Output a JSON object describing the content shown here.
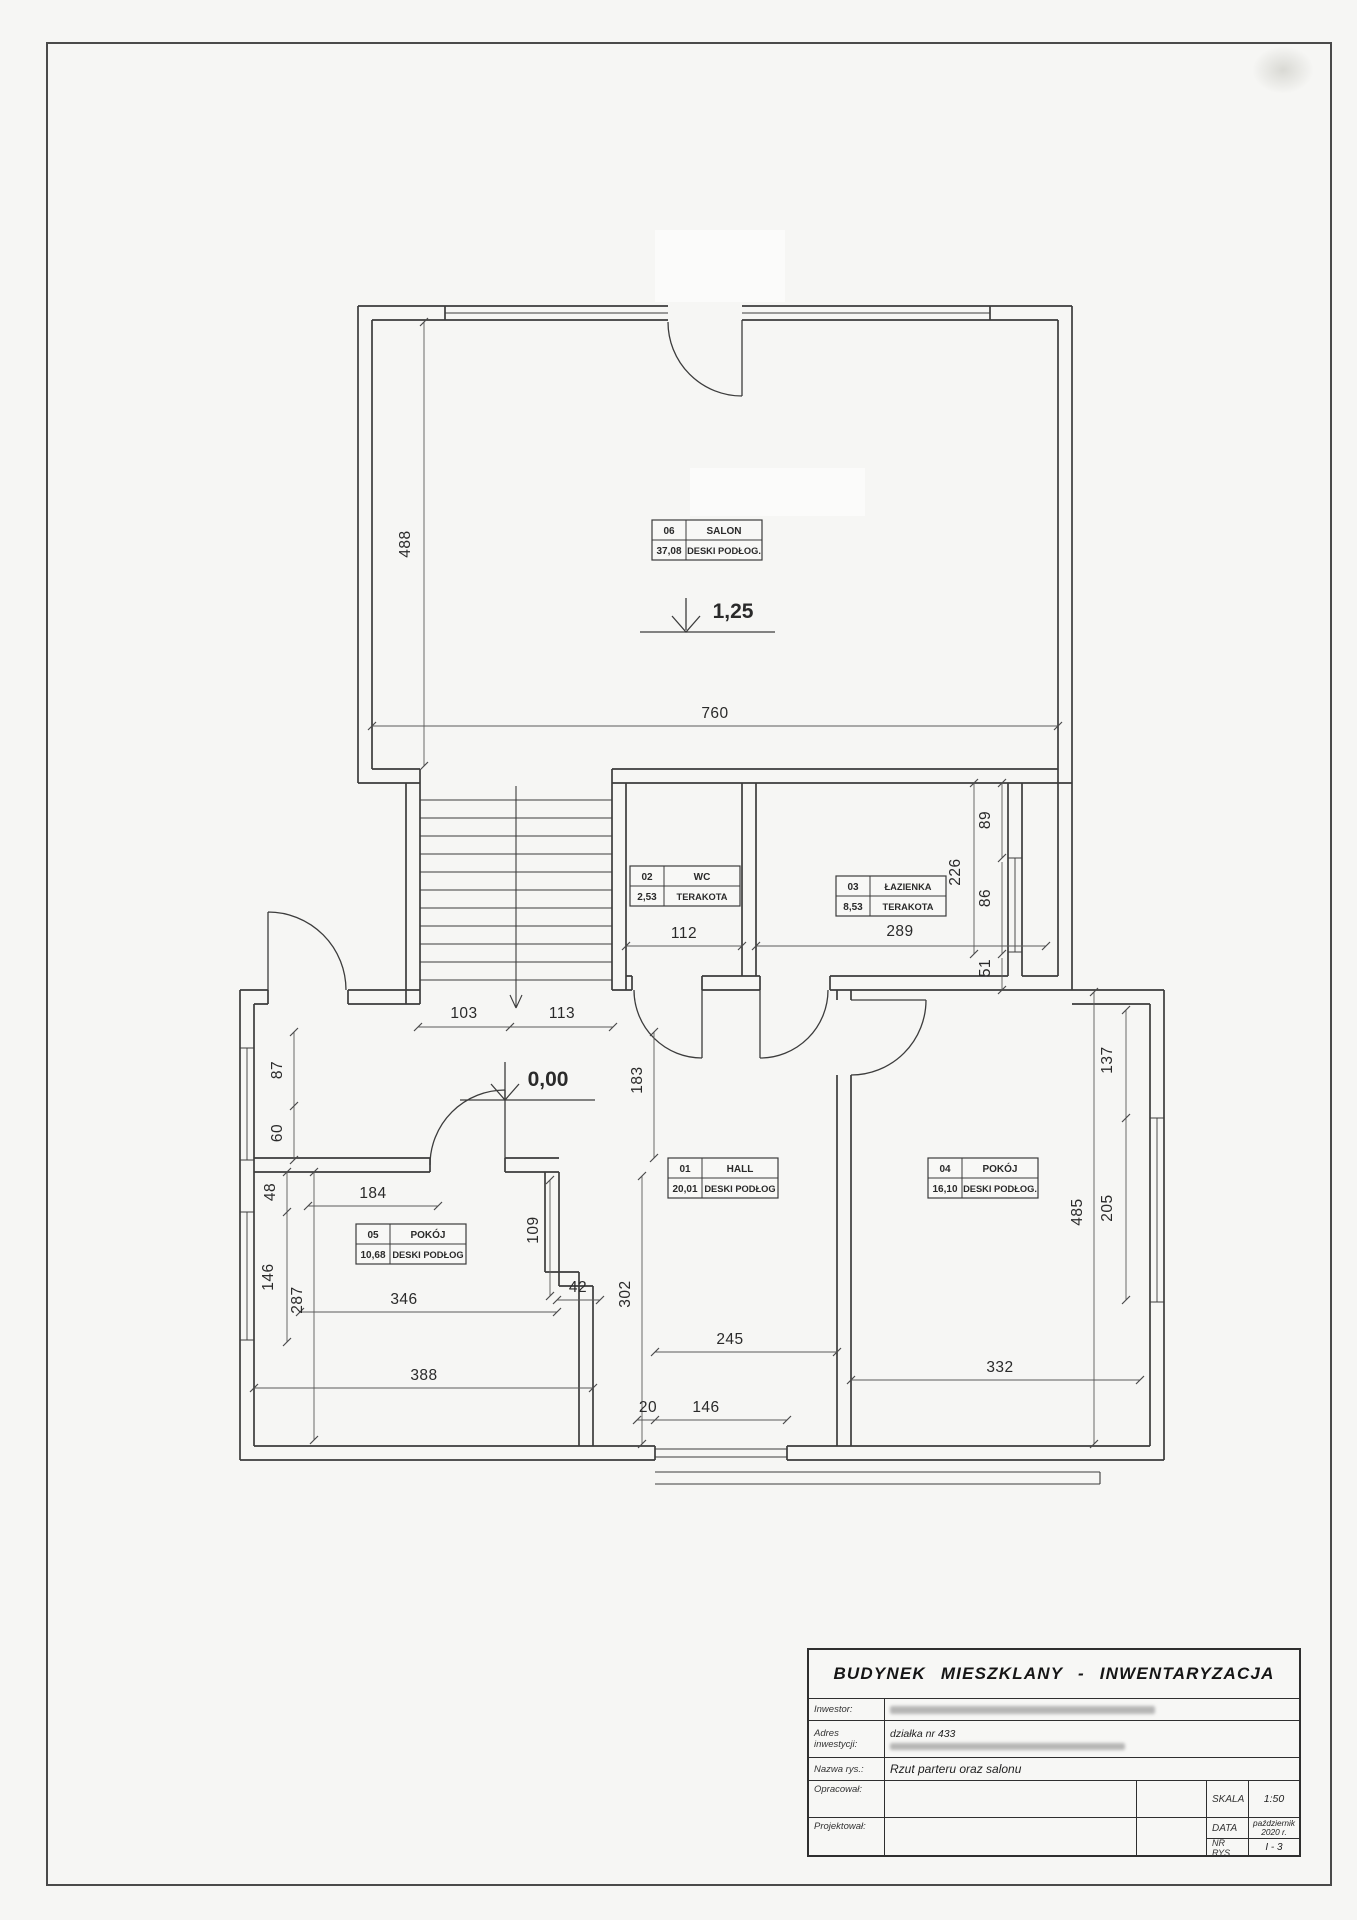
{
  "title_block": {
    "title": "BUDYNEK MIESZKLANY - INWENTARYZACJA",
    "inwestor_label": "Inwestor:",
    "adres_label": "Adres inwestycji:",
    "adres_value": "działka nr 433",
    "nazwa_label": "Nazwa rys.:",
    "nazwa_value": "Rzut parteru oraz salonu",
    "opracowal_label": "Opracował:",
    "projektowal_label": "Projektował:",
    "skala_label": "SKALA",
    "skala_value": "1:50",
    "data_label": "DATA",
    "data_value_line1": "październik",
    "data_value_line2": "2020 r.",
    "nr_label": "NR RYS.",
    "nr_value": "I - 3"
  },
  "rooms": {
    "salon": {
      "id": "06",
      "name": "SALON",
      "area": "37,08",
      "floor": "DESKI PODŁOG."
    },
    "wc": {
      "id": "02",
      "name": "WC",
      "area": "2,53",
      "floor": "TERAKOTA"
    },
    "bathroom": {
      "id": "03",
      "name": "ŁAZIENKA",
      "area": "8,53",
      "floor": "TERAKOTA"
    },
    "hall": {
      "id": "01",
      "name": "HALL",
      "area": "20,01",
      "floor": "DESKI PODŁOG"
    },
    "room4": {
      "id": "04",
      "name": "POKÓJ",
      "area": "16,10",
      "floor": "DESKI PODŁOG."
    },
    "room5": {
      "id": "05",
      "name": "POKÓJ",
      "area": "10,68",
      "floor": "DESKI PODŁOG"
    }
  },
  "levels": {
    "salon": "1,25",
    "ground": "0,00"
  },
  "dims": {
    "salon_width": "760",
    "salon_height": "488",
    "wc_width": "112",
    "bathroom_width": "289",
    "right_top": "89",
    "right_total": "226",
    "right_mid": "86",
    "right_bottom": "51",
    "stairs_left": "103",
    "stairs_right": "113",
    "hall_entry_depth": "183",
    "left_a": "87",
    "left_b": "60",
    "left_c": "48",
    "left_d": "146",
    "left_total": "287",
    "room5_top": "184",
    "room5_side": "109",
    "room5_step": "42",
    "room5_inner": "346",
    "room5_bottom": "388",
    "hall_height": "302",
    "hall_bottom": "245",
    "door_a": "20",
    "door_b": "146",
    "room4_bottom": "332",
    "room4_height": "485",
    "room4_window": "205",
    "room4_wall": "137"
  },
  "colors": {
    "wall": "#3c3c3c",
    "dim_line": "#5a5a5a",
    "paper": "#f6f6f4"
  }
}
